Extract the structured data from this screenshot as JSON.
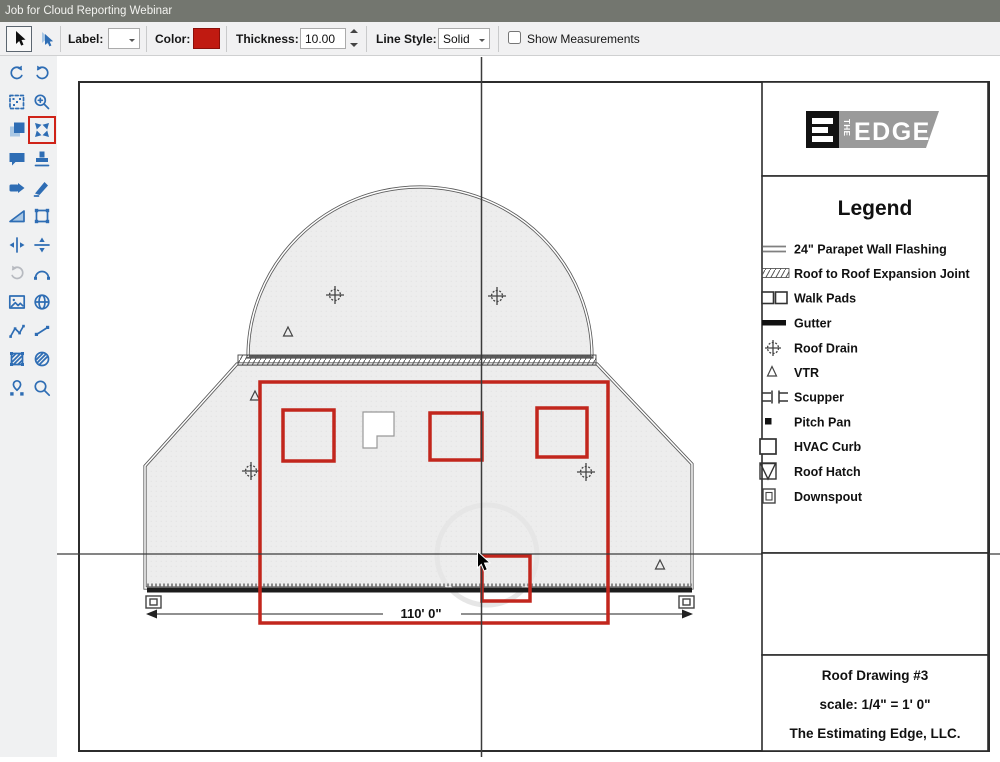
{
  "window": {
    "title": "Job for Cloud Reporting Webinar"
  },
  "toolbar": {
    "label": "Label:",
    "color": "Color:",
    "color_value": "#c01a11",
    "thickness": "Thickness:",
    "thickness_value": "10.00",
    "line_style": "Line Style:",
    "line_style_value": "Solid",
    "show_measurements": "Show Measurements",
    "show_measurements_checked": false
  },
  "sidebar": {
    "highlighted_tool": "fit-extents",
    "tools": [
      "undo",
      "redo",
      "marquee-select",
      "zoom-window",
      "layers",
      "fit-extents",
      "comment",
      "stamp",
      "tag",
      "spray",
      "slope",
      "rectangle",
      "split-vertical",
      "split-horizontal",
      "repeat",
      "arc",
      "image",
      "globe",
      "polyline",
      "segment",
      "hatch-area",
      "texture",
      "pin-map",
      "search"
    ]
  },
  "drawing": {
    "dimension_label": "110' 0\"",
    "annotation_color": "#c2261d"
  },
  "legend": {
    "title": "Legend",
    "items": [
      {
        "symbol": "double-line",
        "label": "24\" Parapet Wall Flashing"
      },
      {
        "symbol": "hatch-strip",
        "label": "Roof to Roof Expansion Joint"
      },
      {
        "symbol": "two-squares",
        "label": "Walk Pads"
      },
      {
        "symbol": "thick-line",
        "label": "Gutter"
      },
      {
        "symbol": "drain",
        "label": "Roof Drain"
      },
      {
        "symbol": "triangle",
        "label": "VTR"
      },
      {
        "symbol": "scupper",
        "label": "Scupper"
      },
      {
        "symbol": "filled-square",
        "label": "Pitch Pan"
      },
      {
        "symbol": "square",
        "label": "HVAC Curb"
      },
      {
        "symbol": "triangle-in-square",
        "label": "Roof Hatch"
      },
      {
        "symbol": "downspout",
        "label": "Downspout"
      }
    ]
  },
  "logo": {
    "the": "THE",
    "edge": "EDGE"
  },
  "title_block": {
    "line1": "Roof Drawing #3",
    "line2": "scale: 1/4\" = 1' 0\"",
    "line3": "The Estimating Edge, LLC."
  }
}
